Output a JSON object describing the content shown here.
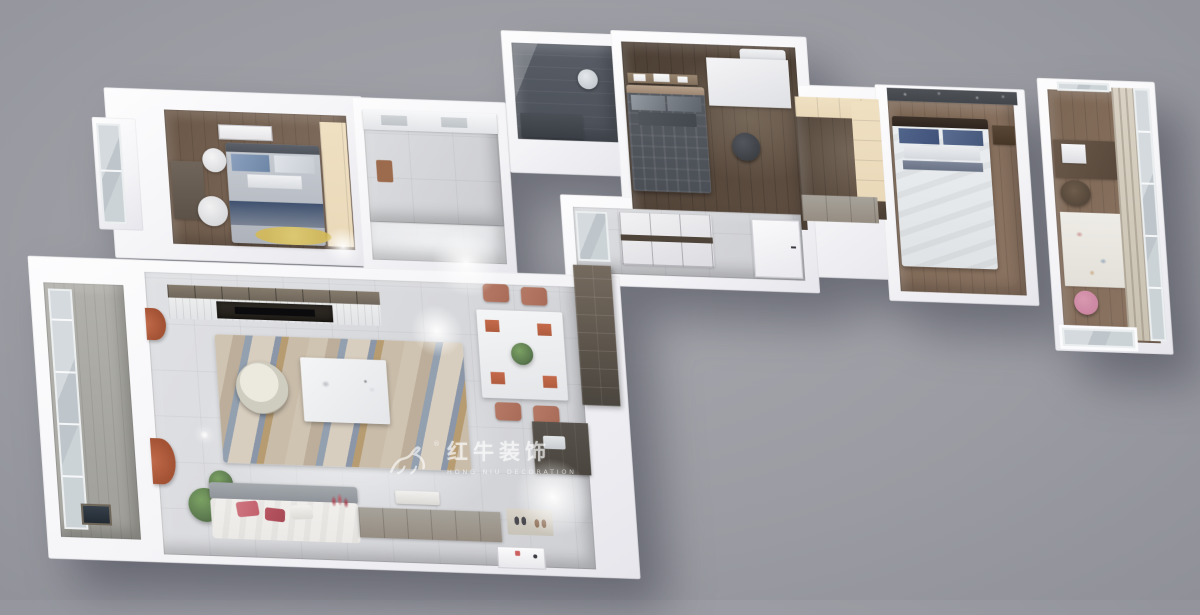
{
  "watermark": {
    "brand": "红牛装饰",
    "tagline": "HONG NIU DECORATION",
    "registered_mark": "®",
    "logo": "bull-logo-icon"
  },
  "palette": {
    "bg": "#9b9ca3",
    "slab": "#f4f4f7",
    "wood-dark": "#4c3f34",
    "wood-mid": "#7b6553",
    "wood-warm": "#6a5747",
    "cream": "#ead9b9",
    "dark-wall": "#4e5257",
    "shower": "#585d66",
    "navy": "#3f516f",
    "blue-pillow": "#8aa0bd",
    "plaid": "#575b62",
    "master-white": "#eceff1",
    "rug-yellow": "#d3b955",
    "rug-beige": "#cfc3b1",
    "rug-blue": "#93a0b0",
    "rug-tan": "#b79c72",
    "sofa": "#eceae7",
    "sofa-back": "#a3a8ad",
    "rose": "#c2606c",
    "terracotta": "#a86b58",
    "orange": "#c06a4a",
    "curtain": "#d9d2c4",
    "glass": "#c6cdd1",
    "counter-dark": "#4a453e",
    "cabinet": "#968d82",
    "green": "#5d7b50",
    "watermark": "rgba(255,255,255,0.62)"
  },
  "scene": {
    "view": "3d-dollhouse-floorplan-render",
    "rooms": [
      {
        "name": "bedroom-left",
        "furniture": [
          "double-bed-navy-runner",
          "wall-art",
          "desk",
          "white-chair",
          "round-side-table",
          "wardrobe",
          "yellow-round-rug",
          "bay-window"
        ]
      },
      {
        "name": "bathroom",
        "furniture": [
          "vanity-counter",
          "floor-mat",
          "corridor"
        ]
      },
      {
        "name": "shower-room",
        "furniture": [
          "dark-glass-shower",
          "shower-head",
          "dark-vanity"
        ]
      },
      {
        "name": "bedroom-middle",
        "furniture": [
          "plaid-bed",
          "picture-ledge",
          "white-desk",
          "black-stool",
          "air-conditioner"
        ]
      },
      {
        "name": "walk-in-closet",
        "furniture": [
          "cream-cabinets",
          "drawer-unit"
        ]
      },
      {
        "name": "master-bedroom",
        "furniture": [
          "white-bed-blue-pillows",
          "floral-accent-wall",
          "nightstand"
        ]
      },
      {
        "name": "study-balcony",
        "furniture": [
          "desk-with-printer",
          "chair",
          "white-art-rug",
          "pink-stool",
          "curtain-wall",
          "window-wall",
          "recessed-window"
        ]
      },
      {
        "name": "hallway",
        "furniture": [
          "panel-cabinets",
          "glass-cabinet",
          "door"
        ]
      },
      {
        "name": "balcony-left",
        "furniture": [
          "window-wall",
          "floor-picture"
        ]
      },
      {
        "name": "living-room",
        "furniture": [
          "tv-media-wall",
          "marble-rug",
          "coffee-table",
          "rattan-chair",
          "floor-lamp",
          "sofa-rose-pillows",
          "plants",
          "orange-curtains"
        ]
      },
      {
        "name": "dining-area",
        "furniture": [
          "dining-table-placemats",
          "terracotta-chairs",
          "centerpiece-plant",
          "tall-dark-cabinet"
        ]
      },
      {
        "name": "kitchen-nook",
        "furniture": [
          "dark-counter",
          "sink"
        ]
      },
      {
        "name": "entry",
        "furniture": [
          "shoe-cabinet",
          "bench",
          "doormat-with-shoes",
          "entry-door"
        ]
      }
    ]
  }
}
